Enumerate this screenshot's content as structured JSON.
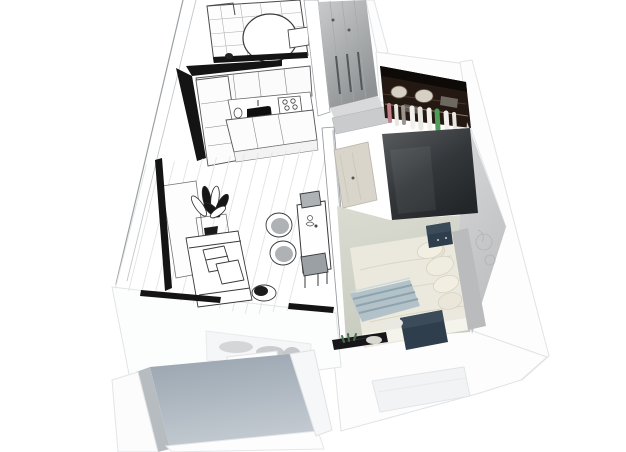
{
  "canvas": {
    "width": 626,
    "height": 452
  },
  "colors": {
    "background": "#ffffff",
    "sketch_line": "#3a3a3c",
    "sketch_black": "#141414",
    "wall_white": "#fdfdfe",
    "wall_edge": "#e0e3e5",
    "closet_grey": "#b9bcbe",
    "hall_floor": "#d8d9da",
    "wardrobe_interior": "#241912",
    "wardrobe_ceiling": "#0d0a08",
    "wardrobe_top": "#3a3e41",
    "door_wood": "#d9d5cb",
    "bedroom_floor": "#ced1c6",
    "bedroom_wall": "#c9cbcc",
    "bed_duvet": "#ebe9dd",
    "pillow": "#f2efe2",
    "sheet_white": "#f4f3ec",
    "blanket_blue": "#b3c2c9",
    "blanket_stripe": "#8da4ae",
    "headboard_grey": "#b9bbbc",
    "navy_furniture": "#2f3e4c",
    "navy_top": "#3c4b59",
    "radiator_black": "#17171a",
    "plant_green": "#47714e",
    "clothes_green": "#4e9e58",
    "clothes_pink": "#c2808a",
    "hatbox_cream": "#d6cfc4",
    "balcony_floor": "#a6b0ba",
    "seat_grey": "#aeb2b5",
    "window_glass": "#f4f6f7",
    "window_recess": "#f1f3f4"
  }
}
